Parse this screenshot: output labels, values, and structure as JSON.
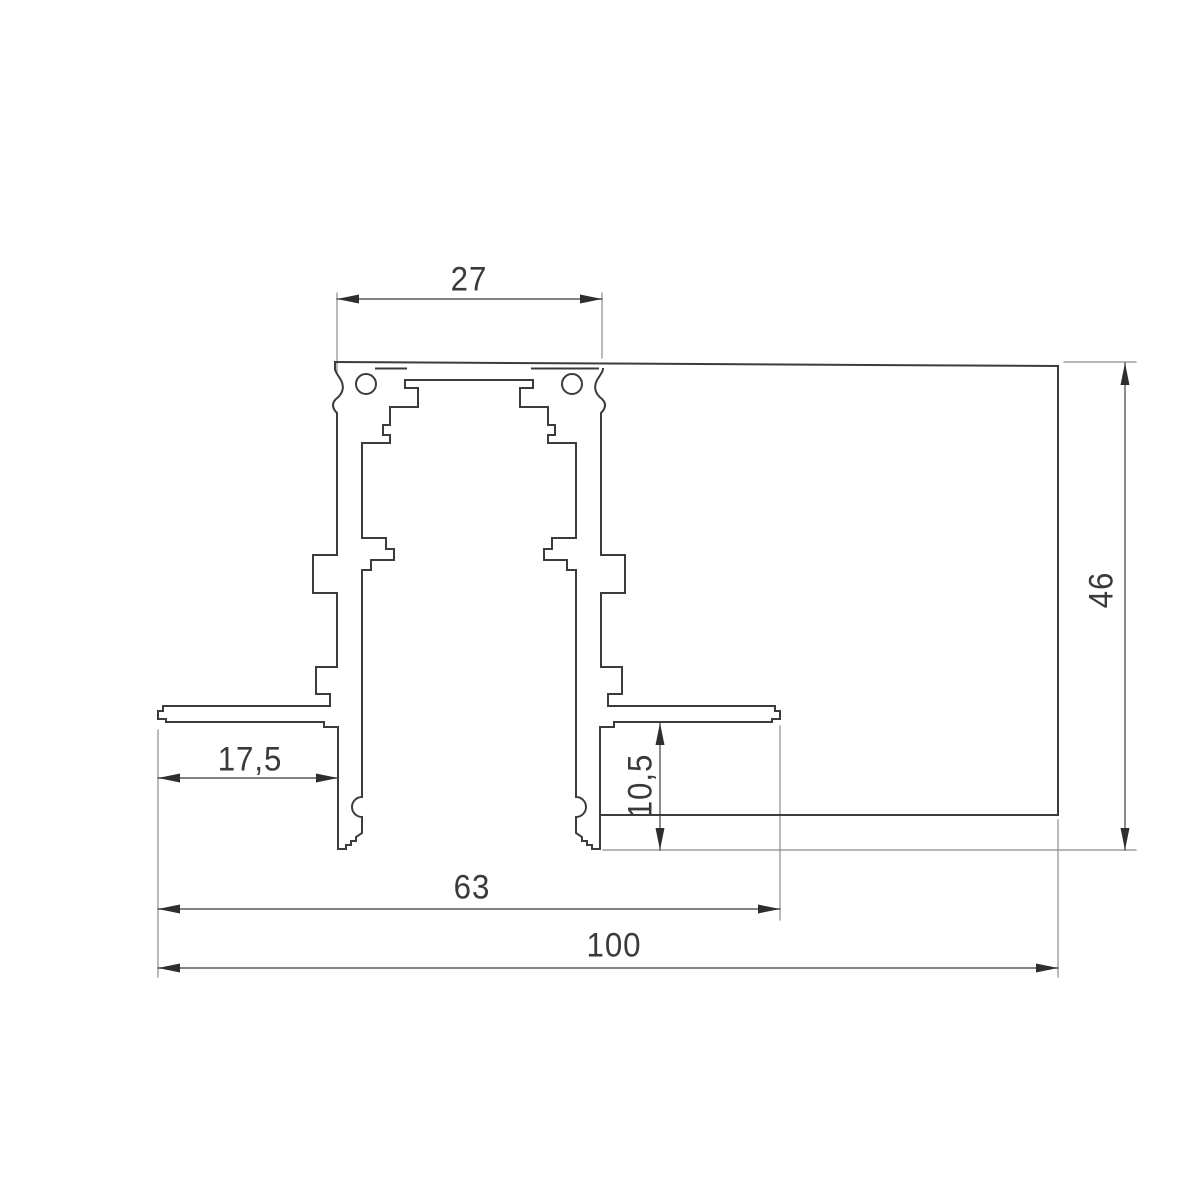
{
  "drawing": {
    "type": "technical-cross-section",
    "subject": "recessed aluminium track profile cross-section",
    "units": "mm",
    "background": "#ffffff",
    "profile_line_color": "#3c3c3c",
    "dimension_line_color": "#5a5a5a",
    "extension_line_color": "#8c8c8c",
    "text_color": "#3a3a3a"
  },
  "dims": {
    "track_opening_width": "27",
    "total_height": "46",
    "left_flange_width": "17,5",
    "lower_pocket_height": "10,5",
    "inner_width": "63",
    "total_width": "100"
  }
}
